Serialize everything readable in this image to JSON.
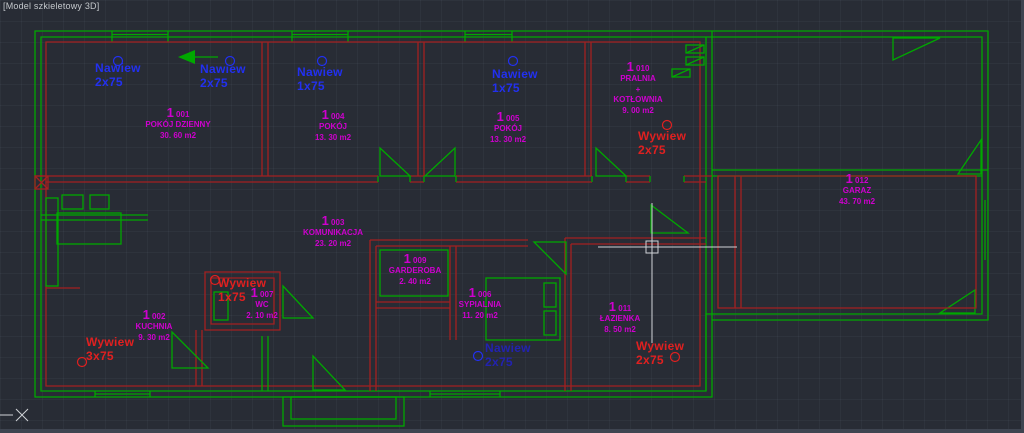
{
  "viewport": {
    "title": "[Model szkieletowy 3D]"
  },
  "colors": {
    "background": "#282c35",
    "green": "#00a800",
    "red_wall": "#a32020",
    "room": "#cf00cf",
    "nawiew": "#2230f0",
    "nawiew_dark": "#2222b0",
    "wywiew": "#e02020",
    "crosshair": "#cfd2d6",
    "title": "#c4c8cc"
  },
  "rooms": [
    {
      "big": "1",
      "id": "001",
      "name": [
        "POKÓJ DZIENNY"
      ],
      "area": "30. 60 m2",
      "x": 178,
      "y": 106
    },
    {
      "big": "1",
      "id": "004",
      "name": [
        "POKÓJ"
      ],
      "area": "13. 30 m2",
      "x": 333,
      "y": 108
    },
    {
      "big": "1",
      "id": "005",
      "name": [
        "POKÓJ"
      ],
      "area": "13. 30 m2",
      "x": 508,
      "y": 110
    },
    {
      "big": "1",
      "id": "010",
      "name": [
        "PRALNIA",
        "+",
        "KOTŁOWNIA"
      ],
      "area": "9. 00 m2",
      "x": 638,
      "y": 60
    },
    {
      "big": "1",
      "id": "012",
      "name": [
        "GARAZ"
      ],
      "area": "43. 70 m2",
      "x": 857,
      "y": 172
    },
    {
      "big": "1",
      "id": "003",
      "name": [
        "KOMUNIKACJA"
      ],
      "area": "23. 20 m2",
      "x": 333,
      "y": 214
    },
    {
      "big": "1",
      "id": "009",
      "name": [
        "GARDEROBA"
      ],
      "area": "2. 40 m2",
      "x": 415,
      "y": 252
    },
    {
      "big": "1",
      "id": "007",
      "name": [
        "WC"
      ],
      "area": "2. 10 m2",
      "x": 262,
      "y": 286
    },
    {
      "big": "1",
      "id": "002",
      "name": [
        "KUCHNIA"
      ],
      "area": "9. 30 m2",
      "x": 154,
      "y": 308
    },
    {
      "big": "1",
      "id": "006",
      "name": [
        "SYPIALNIA"
      ],
      "area": "11. 20 m2",
      "x": 480,
      "y": 286
    },
    {
      "big": "1",
      "id": "011",
      "name": [
        "ŁAZIENKA"
      ],
      "area": "8. 50 m2",
      "x": 620,
      "y": 300
    }
  ],
  "vents": [
    {
      "type": "nawiew",
      "label": "Nawiew",
      "value": "2x75",
      "x": 95,
      "y": 62,
      "dark": false
    },
    {
      "type": "nawiew",
      "label": "Nawiew",
      "value": "2x75",
      "x": 200,
      "y": 63,
      "dark": false
    },
    {
      "type": "nawiew",
      "label": "Nawiew",
      "value": "1x75",
      "x": 297,
      "y": 66,
      "dark": false
    },
    {
      "type": "nawiew",
      "label": "Nawiew",
      "value": "1x75",
      "x": 492,
      "y": 68,
      "dark": false
    },
    {
      "type": "nawiew",
      "label": "Nawiew",
      "value": "2x75",
      "x": 485,
      "y": 342,
      "dark": true
    },
    {
      "type": "wywiew",
      "label": "Wywiew",
      "value": "2x75",
      "x": 638,
      "y": 130,
      "dark": false
    },
    {
      "type": "wywiew",
      "label": "Wywiew",
      "value": "1x75",
      "x": 218,
      "y": 277,
      "dark": false
    },
    {
      "type": "wywiew",
      "label": "Wywiew",
      "value": "3x75",
      "x": 86,
      "y": 336,
      "dark": false
    },
    {
      "type": "wywiew",
      "label": "Wywiew",
      "value": "2x75",
      "x": 636,
      "y": 340,
      "dark": false
    }
  ],
  "cursor": {
    "x": 652,
    "y": 247
  }
}
